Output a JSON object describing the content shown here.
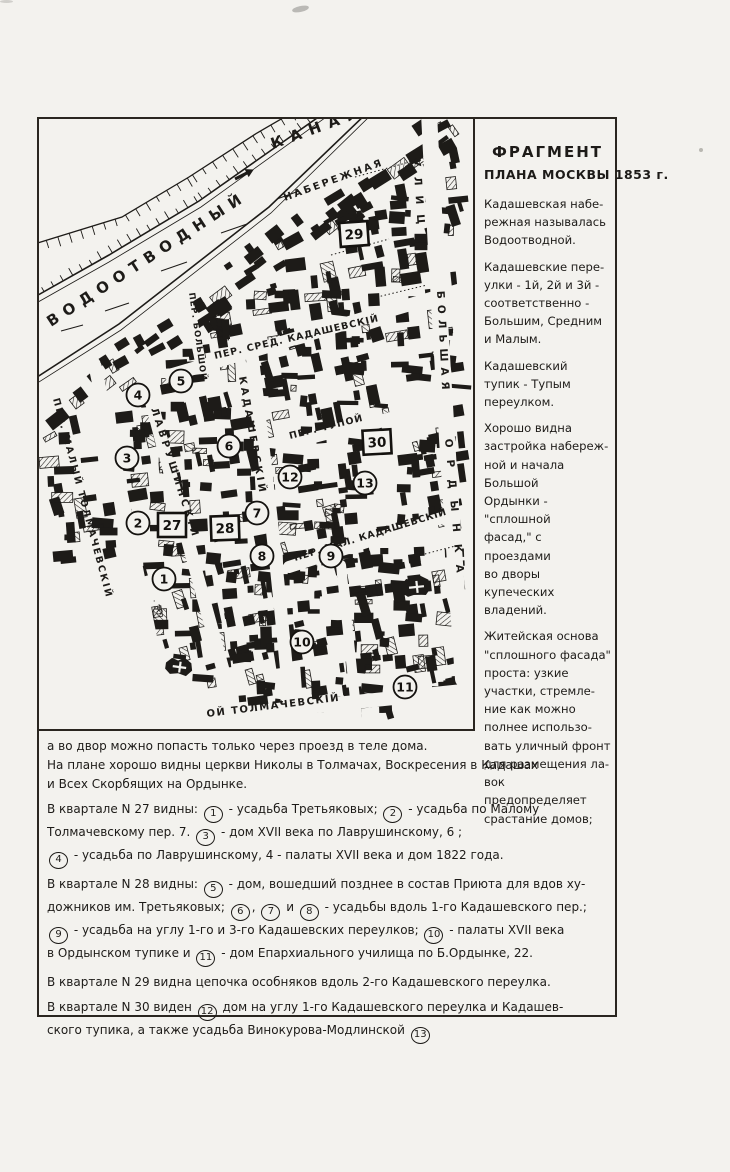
{
  "legend": {
    "title1": "ФРАГМЕНТ",
    "title2": "ПЛАНА МОСКВЫ 1853 г.",
    "paragraphs": [
      {
        "lines": [
          "Кадашевская набе-",
          "режная называлась",
          "Водоотводной."
        ]
      },
      {
        "lines": [
          "Кадашевские пере-",
          "улки - 1й, 2й и 3й -",
          "соответственно -",
          "Большим, Средним",
          "и Малым."
        ]
      },
      {
        "lines": [
          "Кадашевский",
          "тупик - Тупым",
          "переулком."
        ]
      },
      {
        "lines": [
          "Хорошо видна",
          "застройка набереж-",
          "ной и начала Большой",
          "Ордынки - \"сплошной",
          "фасад,\" с проездами",
          "во дворы купеческих",
          "владений."
        ]
      },
      {
        "lines": [
          "Житейская основа",
          "\"сплошного фасада\"",
          "проста: узкие",
          "участки, стремле-",
          "ние как можно",
          "полнее использо-",
          "вать уличный фронт",
          "для размещения ла-",
          "вок предопределяет",
          "срастание домов;"
        ]
      }
    ]
  },
  "map": {
    "street_labels": [
      "ВОДООТВОДНЫЙ",
      "КАНАЛ",
      "НАБЕРЕЖНАЯ",
      "ПЕР. МАЛЫЙ ТОЛМАЧЕВСКІЙ",
      "ЛАВРУШИНСКІЙ",
      "ПЕР. БОЛЬШОЙ",
      "КАДАШЕВСКІЙ",
      "ПЕР. СРЕД. КАДАШЕВСКІЙ",
      "ПЕР. ТУПОЙ",
      "ПЕР. МАЛ. КАДАШЕВСКІЙ",
      "ОЙ ТОЛМАЧЕВСКІЙ",
      "УЛИЦА",
      "БОЛЬШАЯ",
      "ОРДЫНКА"
    ],
    "circle_numbers": [
      "1",
      "2",
      "3",
      "4",
      "5",
      "6",
      "7",
      "8",
      "9",
      "10",
      "11",
      "12",
      "13"
    ],
    "quarter_numbers": [
      "27",
      "28",
      "29",
      "30"
    ],
    "page_mark": "· 30"
  },
  "notes": {
    "paras": [
      {
        "lines": [
          [
            {
              "t": "а во двор можно попасть только через проезд в теле дома."
            }
          ],
          [
            {
              "t": "На плане хорошо видны церкви Николы в Толмачах, Воскресения в Кадашах"
            }
          ],
          [
            {
              "t": "и Всех Скорбящих на Ордынке."
            }
          ]
        ]
      },
      {
        "lines": [
          [
            {
              "t": "В квартале N 27 видны: "
            },
            {
              "c": "1"
            },
            {
              "t": " - усадьба Третьяковых; "
            },
            {
              "c": "2"
            },
            {
              "t": " - усадьба по Малому"
            }
          ],
          [
            {
              "t": "Толмачевскому пер. 7.   "
            },
            {
              "c": "3"
            },
            {
              "t": " - дом XVII века по Лаврушинскому, 6 ;"
            }
          ],
          [
            {
              "c": "4"
            },
            {
              "t": " - усадьба по Лаврушинскому, 4 - палаты XVII века и дом 1822 года."
            }
          ]
        ]
      },
      {
        "lines": [
          [
            {
              "t": "В квартале N 28 видны: "
            },
            {
              "c": "5"
            },
            {
              "t": " - дом, вошедший позднее в состав Приюта для вдов ху-"
            }
          ],
          [
            {
              "t": "дожников им. Третьяковых; "
            },
            {
              "c": "6"
            },
            {
              "t": ", "
            },
            {
              "c": "7"
            },
            {
              "t": " и "
            },
            {
              "c": "8"
            },
            {
              "t": " - усадьбы вдоль 1-го Кадашевского пер.;"
            }
          ],
          [
            {
              "c": "9"
            },
            {
              "t": " - усадьба на углу 1-го и 3-го Кадашевских переулков; "
            },
            {
              "c": "10"
            },
            {
              "t": " - палаты XVII века"
            }
          ],
          [
            {
              "t": "в Ордынском тупике и "
            },
            {
              "c": "11"
            },
            {
              "t": " - дом Епархиального училища по Б.Ордынке, 22."
            }
          ]
        ]
      },
      {
        "lines": [
          [
            {
              "t": "В квартале N 29 видна цепочка особняков вдоль 2-го Кадашевского переулка."
            }
          ]
        ]
      },
      {
        "lines": [
          [
            {
              "t": "В квартале N 30 виден "
            },
            {
              "c": "12"
            },
            {
              "t": " дом на углу 1-го Кадашевского переулка и Кадашев-"
            }
          ],
          [
            {
              "t": "ского тупика, а также усадьба Винокурова-Модлинской "
            },
            {
              "c": "13"
            }
          ]
        ]
      }
    ]
  }
}
